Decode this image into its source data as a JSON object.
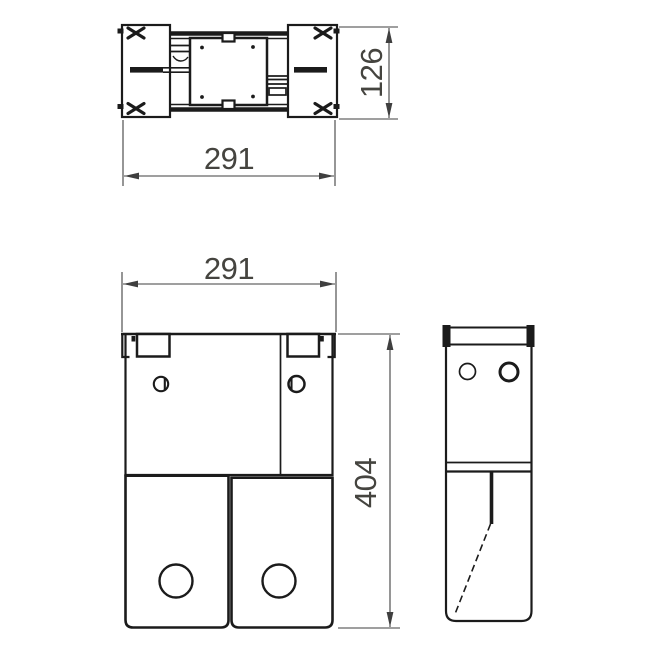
{
  "colors": {
    "background": "#ffffff",
    "line": "#1b1b1b",
    "dimension": "#3f3f3f",
    "text": "#45443f"
  },
  "dimensions": {
    "top_view_width": "291",
    "top_view_depth": "126",
    "front_view_width": "291",
    "front_view_height": "404"
  }
}
